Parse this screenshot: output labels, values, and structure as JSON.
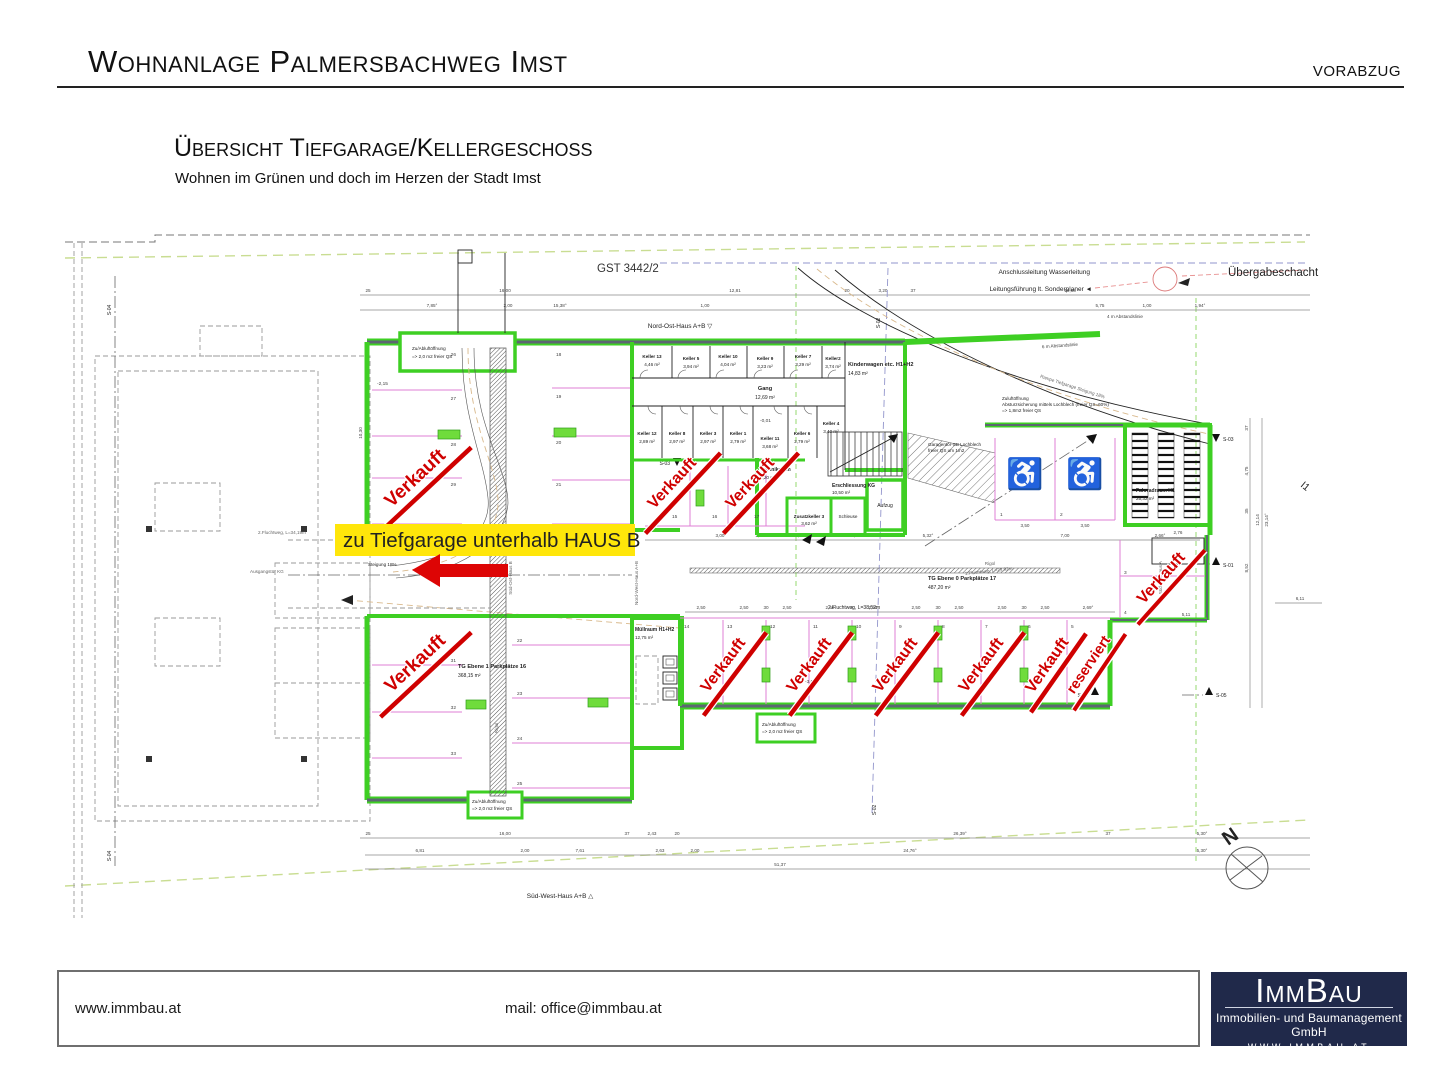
{
  "header": {
    "title": "Wohnanlage Palmersbachweg Imst",
    "stamp": "VORABZUG"
  },
  "subtitle": {
    "title": "Übersicht Tiefgarage/Kellergeschoss",
    "tagline": "Wohnen im Grünen und doch im Herzen der Stadt Imst"
  },
  "plan": {
    "parcel": "GST 3442/2",
    "highlight": "zu Tiefgarage unterhalb HAUS B",
    "sold": "Verkauft",
    "reserved": "reserviert",
    "notes": {
      "anschluss": "Anschlussleitung Wasserleitung",
      "leitung": "Leitungsführung lt. Sonderplaner ◄",
      "uebergabe": "Übergabeschacht",
      "nordost": "Nord-Ost-Haus A+B ▽",
      "suedwest": "Süd-West-Haus A+B △",
      "suedost_a": "△ Süd-Ost-Haus A",
      "suedost_b": "Süd-Ost-Haus B",
      "nordwest": "Nord-West-Haus A+B",
      "abstand4": "4 m Abstandslinie",
      "abstand6": "6 m Abstandslinie",
      "rampe": "Rampe Tiefgarage Steigung 18%",
      "zuluft1": "Zuluftöffnung",
      "zuluft2": "Absturzsicherung mittels Lochblech (freier QS=60%)",
      "zuluft3": "=> 1,8m2 freier QS",
      "garagentor1": "Garagentor-SB Lochblech",
      "garagentor2": "freier QS um 1m2",
      "zuab1": "Zu/Abluftöffnung",
      "zuab2": "=> 2,0 m2 freier QS",
      "steigung": "Steigung 18%",
      "flucht1": "1.Fluchtweg, L=23,92m",
      "flucht2a": "2.Fluchtweg, L=34,19m",
      "flucht2b": "2.Fluchtweg, L=38,52m",
      "ausgang": "Ausgangstür KG",
      "rigol": "Rigol",
      "lvl_a": "-2,15",
      "lvl_b": "-0,01",
      "lvl_c": "-3,01"
    },
    "rooms": {
      "kinderwagen": {
        "n": "Kinderwagen etc. H1+H2",
        "a": "14,83 m²"
      },
      "gang": {
        "n": "Gang",
        "a": "12,69 m²"
      },
      "technik": {
        "n": "Technikraum",
        "a": "9,20 m²"
      },
      "erschliessung": {
        "n": "Erschliessung KG",
        "a": "10,50 m²"
      },
      "zusatzkeller": {
        "n": "Zusatzkeller 3",
        "a": "3,62 m²"
      },
      "schleuse": {
        "n": "Schleuse"
      },
      "aufzug": {
        "n": "Aufzug"
      },
      "muellraum": {
        "n": "Müllraum H1+H2",
        "a": "12,75 m²"
      },
      "fahrrad": {
        "n": "Fahrradraum H1",
        "a": "25,32 m²"
      },
      "tg1": {
        "n": "TG Ebene 1 Parkplätze 16",
        "a": "368,15 m²"
      },
      "tg0": {
        "n": "TG Ebene 0 Parkplätze 17",
        "a": "487,20 m²"
      }
    },
    "keller_top": [
      {
        "n": "Keller 13",
        "a": "4,46 m²"
      },
      {
        "n": "Keller 5",
        "a": "3,94 m²"
      },
      {
        "n": "Keller 10",
        "a": "4,04 m²"
      },
      {
        "n": "Keller 9",
        "a": "3,23 m²"
      },
      {
        "n": "Keller 7",
        "a": "3,29 m²"
      },
      {
        "n": "Keller2",
        "a": "3,74 m²"
      }
    ],
    "keller_bottom": [
      {
        "n": "Keller 12",
        "a": "2,89 m²"
      },
      {
        "n": "Keller 8",
        "a": "2,97 m²"
      },
      {
        "n": "Keller 3",
        "a": "2,97 m²"
      },
      {
        "n": "Keller 1",
        "a": "2,79 m²"
      },
      {
        "n": "Keller 11",
        "a": "3,68 m²"
      },
      {
        "n": "Keller 6",
        "a": "2,79 m²"
      },
      {
        "n": "Keller 4",
        "a": "3,40 m²"
      }
    ],
    "spots": {
      "ul": [
        "26",
        "27",
        "28",
        "29",
        "18",
        "19",
        "20",
        "21"
      ],
      "mid": [
        "15",
        "16",
        "17"
      ],
      "ll": [
        "31",
        "32",
        "33",
        "22",
        "23",
        "24",
        "25"
      ],
      "bottom": [
        "14",
        "13",
        "12",
        "11",
        "10",
        "9",
        "8",
        "7",
        "6",
        "5"
      ],
      "right": [
        "3",
        "4"
      ],
      "hc": [
        "1",
        "2"
      ]
    },
    "markers": {
      "s01": "S-01",
      "s02": "S-02",
      "s03": "S-03",
      "s04": "S-04",
      "s05": "S-05",
      "north": "N",
      "i1": "I1"
    },
    "dims": {
      "top1": [
        "25",
        "16,00",
        "12,81",
        "20",
        "3,20",
        "37",
        "18,63"
      ],
      "top2": [
        "7,85°",
        "2,00",
        "15,38°",
        "1,00",
        "5,75",
        "1,00",
        "1,94°"
      ],
      "road": [
        "3,00",
        "2,50",
        "2,13",
        "20",
        "1,84",
        "5,32°",
        "7,00",
        "2,66°"
      ],
      "b1": [
        "25",
        "16,00",
        "37",
        "2,43",
        "20",
        "26,39°",
        "37",
        "5,30°"
      ],
      "b2": [
        "6,81",
        "2,00",
        "7,61",
        "2,63",
        "2,00",
        "24,76°",
        "5,30°"
      ],
      "b3": "51,37",
      "right": [
        "37",
        "4,75",
        "35",
        "8,52",
        "12,14",
        "23,14°",
        "6,11"
      ],
      "sp_a": "2,50",
      "sp_b": "30",
      "sp_end": "2,69°",
      "d350": "3,50",
      "d511": "5,11",
      "d1030": "10,30",
      "d276": "2,76"
    }
  },
  "footer": {
    "web": "www.immbau.at",
    "mail": "mail: office@immbau.at",
    "logo": {
      "name": "ImmBau",
      "line1": "Immobilien- und Baumanagement GmbH",
      "line2": "WWW.IMMBAU.AT"
    }
  }
}
